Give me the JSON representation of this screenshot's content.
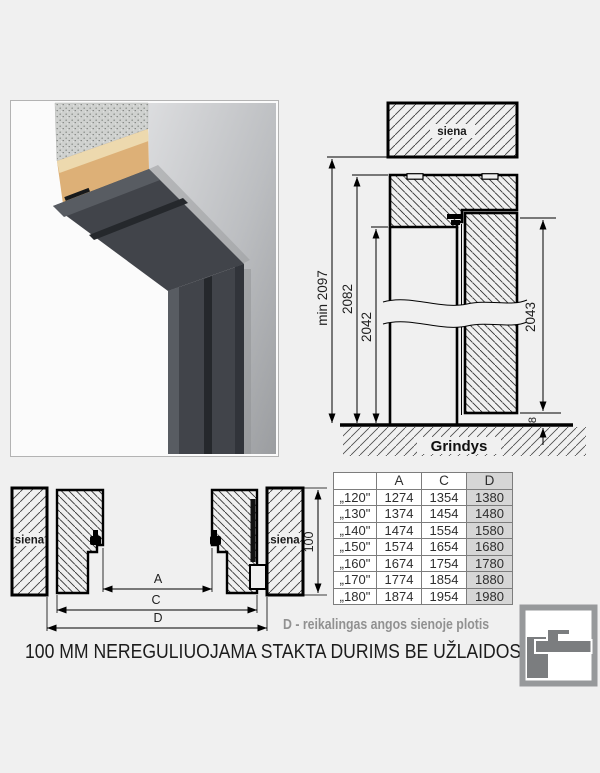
{
  "section": {
    "wall_label": "siena",
    "floor_label": "Grindys",
    "dims": {
      "min_total": "min 2097",
      "frame_outer": "2082",
      "opening": "2042",
      "door": "2043",
      "floor_gap": "8"
    }
  },
  "plan": {
    "wall_label_left": "siena",
    "wall_label_right": "siena",
    "dims": {
      "a": "A",
      "c": "C",
      "d": "D",
      "depth": "100"
    }
  },
  "table": {
    "headers": [
      "",
      "A",
      "C",
      "D"
    ],
    "rows": [
      {
        "size": "„120\"",
        "a": "1274",
        "c": "1354",
        "d": "1380"
      },
      {
        "size": "„130\"",
        "a": "1374",
        "c": "1454",
        "d": "1480"
      },
      {
        "size": "„140\"",
        "a": "1474",
        "c": "1554",
        "d": "1580"
      },
      {
        "size": "„150\"",
        "a": "1574",
        "c": "1654",
        "d": "1680"
      },
      {
        "size": "„160\"",
        "a": "1674",
        "c": "1754",
        "d": "1780"
      },
      {
        "size": "„170\"",
        "a": "1774",
        "c": "1854",
        "d": "1880"
      },
      {
        "size": "„180\"",
        "a": "1874",
        "c": "1954",
        "d": "1980"
      }
    ]
  },
  "notes": {
    "d_note": "D - reikalingas angos sienoje plotis",
    "caption": "100 MM NEREGULIUOJAMA STAKTA DURIMS BE UŽLAIDOS"
  },
  "colors": {
    "background": "#f0f0f0",
    "line": "#000000",
    "table_shade": "#d6d6d6",
    "note_gray": "#919191",
    "frame_dark": "#41444a",
    "logo_gray": "#7b7d7f"
  }
}
